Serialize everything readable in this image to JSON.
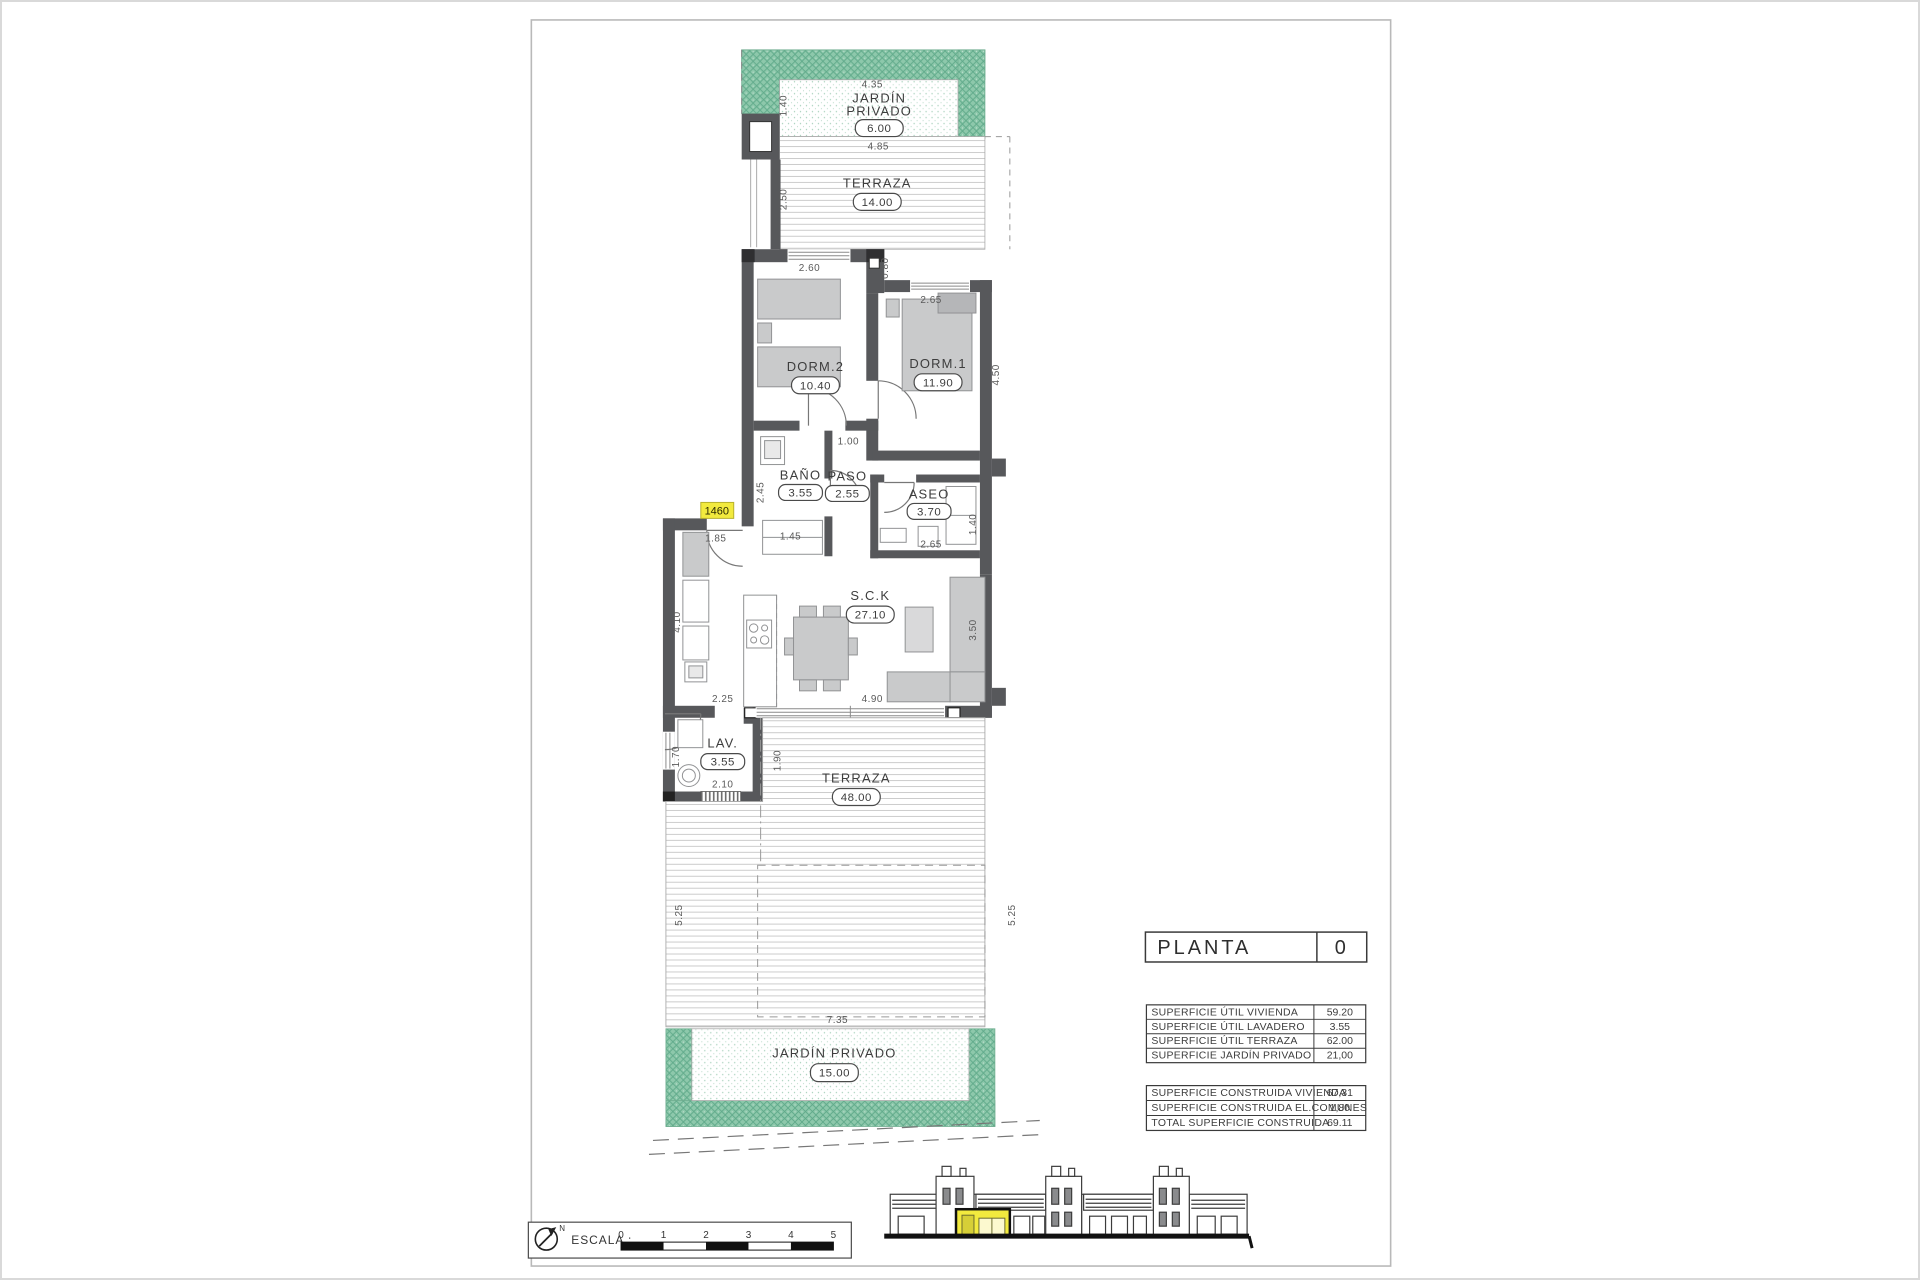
{
  "colors": {
    "garden_green": "#8dc8ab",
    "garden_hatch": "#5fa98a",
    "wall_gray": "#57585b",
    "furniture_gray": "#c9cacb",
    "highlight_yellow": "#f2ea3e"
  },
  "plan": {
    "unit_tag": "1460",
    "rooms": {
      "jardin_top": {
        "label_line1": "JARDÍN",
        "label_line2": "PRIVADO",
        "area": "6.00"
      },
      "terraza_top": {
        "label": "TERRAZA",
        "area": "14.00"
      },
      "dorm2": {
        "label": "DORM.2",
        "area": "10.40"
      },
      "dorm1": {
        "label": "DORM.1",
        "area": "11.90"
      },
      "bano": {
        "label": "BAÑO",
        "area": "3.55"
      },
      "paso": {
        "label": "PASO",
        "area": "2.55"
      },
      "aseo": {
        "label": "ASEO",
        "area": "3.70"
      },
      "sck": {
        "label": "S.C.K",
        "area": "27.10"
      },
      "lav": {
        "label": "LAV.",
        "area": "3.55"
      },
      "terraza_main": {
        "label": "TERRAZA",
        "area": "48.00"
      },
      "jardin_bottom": {
        "label": "JARDÍN  PRIVADO",
        "area": "15.00"
      }
    },
    "dims": {
      "d435": "4.35",
      "d140_top": "1.40",
      "d485": "4.85",
      "d250": "2.50",
      "d260": "2.60",
      "d080": "0.80",
      "d265_dorm1": "2.65",
      "d450": "4.50",
      "d100": "1.00",
      "d245": "2.45",
      "d145": "1.45",
      "d185": "1.85",
      "d265_aseo": "2.65",
      "d140_aseo": "1.40",
      "d410": "4.10",
      "d225": "2.25",
      "d490": "4.90",
      "d350": "3.50",
      "d170": "1.70",
      "d210": "2.10",
      "d190": "1.90",
      "d525_left": "5.25",
      "d525_right": "5.25",
      "d735": "7.35"
    }
  },
  "title_block": {
    "label": "PLANTA",
    "value": "0"
  },
  "tables": {
    "util": {
      "rows": [
        {
          "label": "SUPERFICIE ÚTIL VIVIENDA",
          "value": "59.20"
        },
        {
          "label": "SUPERFICIE ÚTIL LAVADERO",
          "value": "3.55"
        },
        {
          "label": "SUPERFICIE ÚTIL TERRAZA",
          "value": "62.00"
        },
        {
          "label": "SUPERFICIE JARDÍN PRIVADO",
          "value": "21,00"
        }
      ]
    },
    "construida": {
      "rows": [
        {
          "label": "SUPERFICIE CONSTRUIDA VIVIENDA",
          "value": "67,31"
        },
        {
          "label": "SUPERFICIE CONSTRUIDA EL.COMUNES",
          "value": "1,80"
        },
        {
          "label": "TOTAL SUPERFICIE CONSTRUIDA",
          "value": "69.11"
        }
      ]
    }
  },
  "footer": {
    "escala_label": "ESCALA :",
    "north_label": "N",
    "scale_ticks": [
      "0",
      "1",
      "2",
      "3",
      "4",
      "5"
    ]
  }
}
